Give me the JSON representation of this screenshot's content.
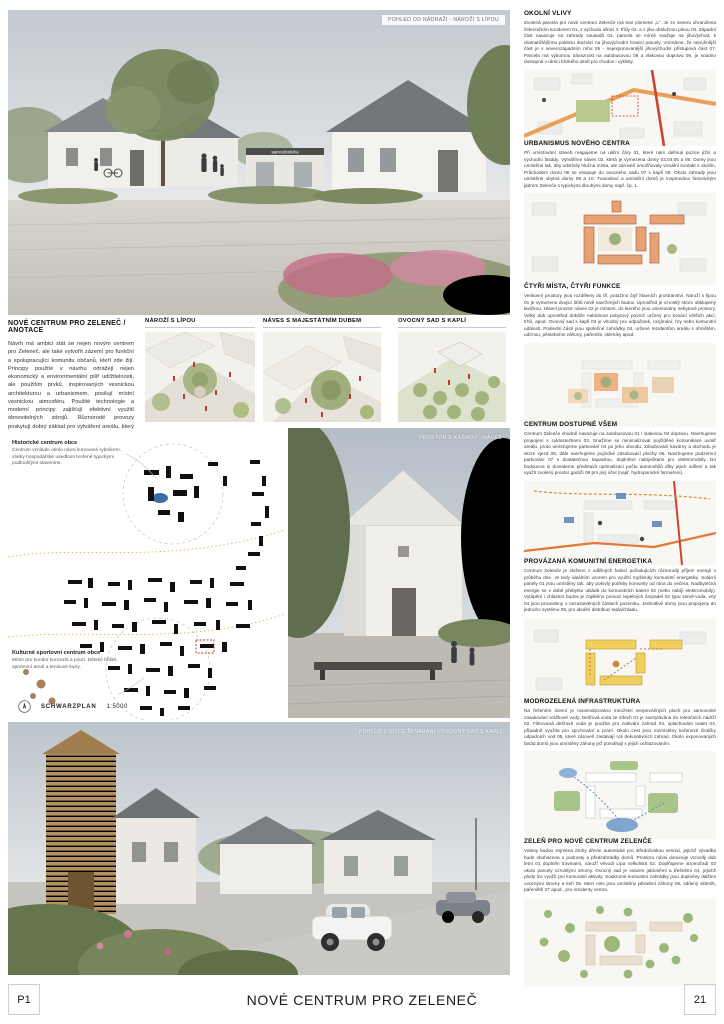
{
  "page": {
    "sheet_left": "P1",
    "title": "NOVÉ CENTRUM PRO ZELENEČ",
    "sheet_right": "21"
  },
  "hero_top": {
    "caption": "POHLED OD NÁDRAŽÍ - NÁROŽÍ S LÍPOU",
    "sign": "samoobsluha"
  },
  "annotation": {
    "heading": "NOVÉ CENTRUM PRO ZELENEČ / ANOTACE",
    "body": "Návrh má ambici stát se nejen novým centrem pro Zeleneč, ale také vytvořit zázemí pro funkční a spolupracující komunitu občanů, kteří zde žijí. Principy použité v návrhu odrážejí nejen ekonomický a environmentální pilíř udržitelnosti, ale použitím prvků, inspirovaných vesnickou architekturou a urbanismem, posilují místní vesnickou atmosféru. Použité technologie a moderní principy zajišťují efektivní využití obnovitelných zdrojů. Různorodé provozy poskytují dobrý základ pro vytváření areálu, který funguje během celého dne, týdne, roku."
  },
  "diagrams": [
    {
      "title": "NÁROŽÍ S LÍPOU"
    },
    {
      "title": "NÁVES S MAJESTÁTNÍM DUBEM"
    },
    {
      "title": "OVOCNÝ SAD S KAPLÍ"
    }
  ],
  "schwarzplan": {
    "label": "SCHWARZPLAN",
    "scale": "1:5000",
    "historic": {
      "title": "Historické centrum obce",
      "body": "Centrum vznikalo okolo návsi lemované rybníkem, statky hospodářské usedlosti tvořené typickými podlouhlými staveními."
    },
    "cultural": {
      "title": "Kulturně sportovní centrum obce",
      "body": "Místo pro konání koncertů a poutí. Dětské hřiště, sportovní areál a tenisové kurty."
    }
  },
  "photo_mid": {
    "caption": "PROSTOR S KAŠNOU - NÁVES"
  },
  "hero_bottom": {
    "caption": "POHLED Z ULICE ŠKVARANI - OVOCNÝ SAD S KAPLÍ"
  },
  "sections": [
    {
      "title": "OKOLNÍ VLIVY",
      "body": "Zvolená parcela pro nové centrum Zelenče má tvar písmene „L“. Je ze severu ohraničena železničním koridorem 01, z východu silnicí 3. třídy 02, a z jihu obslužnou plnou 03. Západní část navazuje na zahrady sousedů 04, parcela se mírně svažuje na jihovýchod, k dramatičtějšímu poklesu dochází na jihovýchodní hranici parcely. Vnímáme, že nejrušnější část je v severozápadním rohu 05 - nejexponovanější jihovýchodní přístupová část 07. Parcela má výbornou návaznost na autobusovou 08 a vlakovou dopravu 09, je snadno dostupná v rámci blízkého okolí pro chodce i cyklisty."
    },
    {
      "title": "URBANISMUS NOVÉHO CENTRA",
      "body": "Při umísťování staveb reagujeme na uliční čáry 01, které nám definují pozice jižní a východní fasády. Vytváříme náves 02, která je vymezena domy 03,04,05 a 06. Domy jsou umístěné tak, aby odstínily hlučná místa, ale zároveň umožňovaly vizuální kontakt s okolím. Průchodem domu 06 se vstupuje do ovocného sadu 07 s kaplí 08. Okolo zahrady jsou umístěné obytné domy 09 a 10. Tvarosloví a umístění domů je inspirováno historickým jádrem Zelenče s typickými dlouhými domy např. čp. 1."
    },
    {
      "title": "ČTYŘI MÍSTA, ČTYŘI FUNKCE",
      "body": "Venkovní prostory jsou rozděleny do tří, potažmo čtyř hlavních prostranství. Nároží s lípou 01 je vymezeno dvojicí štítů nově navržených budov. Uprostřed je vzrostlý strom obklopený lavičkou. Hlavní prostor náves 02 je místem, do kterého jsou orientovány nebytové prostory. Velký dub uprostřed dokáže nabídnout pobytový povrch určený pro konání větších akcí, trhů, apod. Ovocný sad s kaplí 03 je vhodný pro odpočinek, rozjímání, hry nebo komunitní události. Poslední částí jsou společné zahrádky 04, určené rezidentům areálu s ohništěm, udírnou, pěstebními záhony, pařeništi, skleníky apod."
    },
    {
      "title": "CENTRUM DOSTUPNÉ VŠEM",
      "body": "Centrum Zelenče vhodně navazuje na autobusovou 01 i vlakovou 02 dopravu. Navrhujeme propojení s cyklostezkami 03. Snažíme se minimalizovat pojížděné komunikace uvnitř areálu, proto umísťujeme parkování 04 po jeho obvodu. Zásobování kavárny a obchodu je skrze vjezd 05, dále navrhujeme pojízdné zásobovací plochy 06. Navrhujeme podzemní parkování 07 s dostatečnou kapacitou, doplněné nabíječkami pro elektromobily. Do budoucna si dovedeme představit optimalizaci počtu automobilů díky jejich sdílení a tak využít zvolený prostor garáží 08 pro jiný účel (např. hydroponické farmaření)."
    },
    {
      "title": "PROVÁZANÁ KOMUNITNÍ ENERGETIKA",
      "body": "Centrum Zelenče je složeno z odlišných funkcí požadujících různorodý příjem energií v průběhu dne. Je tedy ideálním vzorem pro využití myšlenky komunitní energetiky. Solární panely 01 jsou umístěny tak, aby pokryly potřeby komunity od rána do večera. Nadbytečná energie se v době přebytku ukládá do komunitních baterií 02 (nebo nabíjí elektromobily). Vytápění i chlazení budov je zajištěno pomocí tepelných čerpadel 03 typu země-voda, vrty 04 jsou provedeny v nezastavěných částech pozemku. Jednotlivé domy jsou propojeny do jednoho systému 05, pro ideální distribuci tepla/chladu."
    },
    {
      "title": "MODROZELENÁ INFRASTRUKTURA",
      "body": "Na řešeném území je maximalizováno množství nezpevněných ploch pro samovolné zasakování srážkové vody. Dešťová voda ze střech 01 je zachytávána do retenčních nádrží 02. Filtrovaná dešťová voda je použita pro zalévání zahrad 03, splachování toalet 04, případně využita pro sprchování a praní. Okolo cest jsou rozmístěny kořenové čističky odpadních vod 05, které zároveň zastávají roli dekorativních zahrad. Okolo exponovaných fasád domů jsou umístěny záhony jež pomáhají s jejich ochlazováním."
    },
    {
      "title": "ZELEŇ PRO NOVÉ CENTRUM ZELENČE",
      "body": "Voleny budou zejména druhy dřevin autentické pro středočeskou vesnici, jejichž výsadba bude obohacena o podrosty a předzahrádky domů. Prostoru návsi dominuje vzrostlý dub letní 01 doplněn travinami, nároží vévodí Lípa velkolistá 02. Doplňujeme stromořadí 03 okolo parcely vzrostlými stromy. Ovocný sad je osázen jabloněmi a třešněmi 04, jejichž plody lze využít pro komunitní aktivity. Soukromé komunitní zahrádky jsou doplněny dalšími ovocnými stromy a keři 05. Mezi nimi jsou umístěny pěstební záhony 06, sdílený skleník, pařeniště 07 apod., pro rezidenty centra."
    }
  ]
}
